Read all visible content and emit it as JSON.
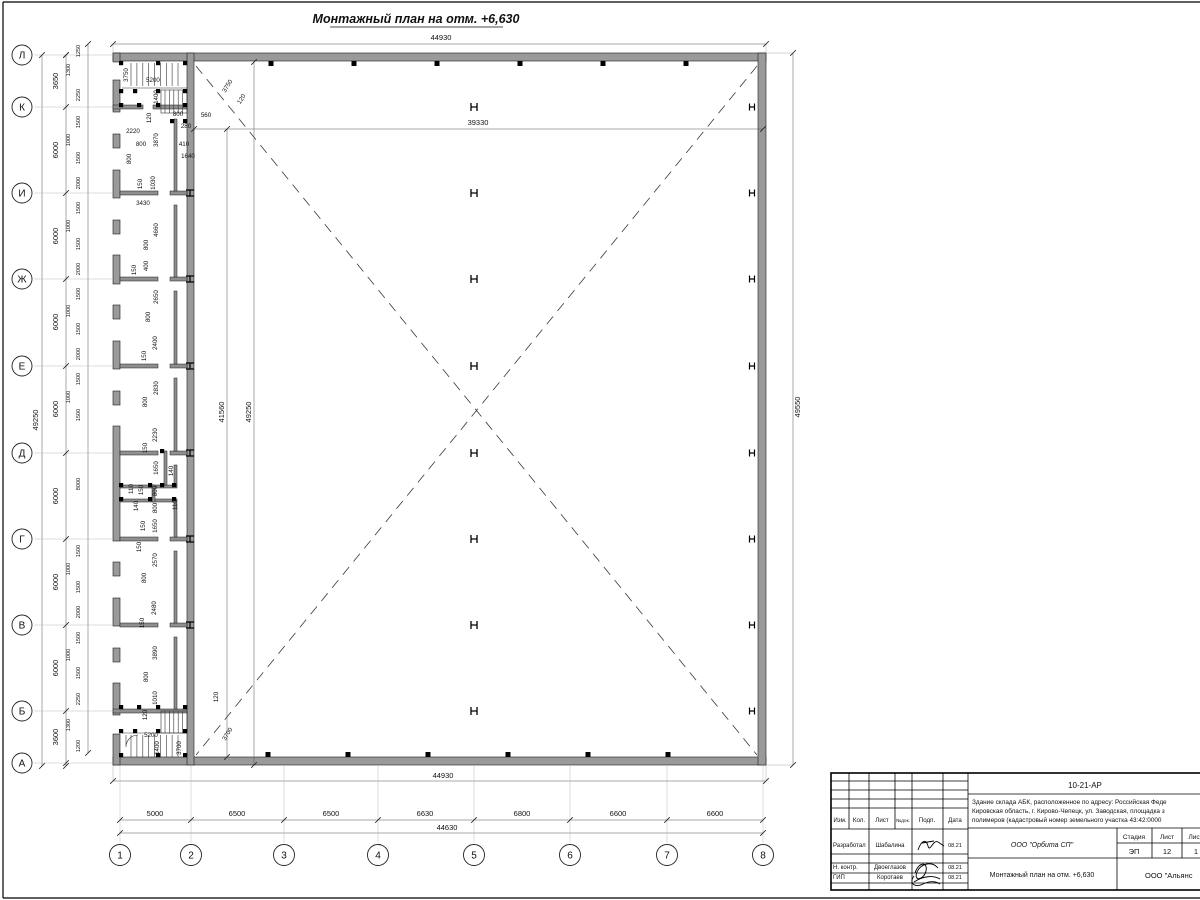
{
  "title": {
    "text": "Монтажный план на отм. +6,630"
  },
  "axes": {
    "left": [
      {
        "l": "Л",
        "y": 55
      },
      {
        "l": "К",
        "y": 107
      },
      {
        "l": "И",
        "y": 193
      },
      {
        "l": "Ж",
        "y": 279
      },
      {
        "l": "Е",
        "y": 366
      },
      {
        "l": "Д",
        "y": 453
      },
      {
        "l": "Г",
        "y": 539
      },
      {
        "l": "В",
        "y": 625
      },
      {
        "l": "Б",
        "y": 711
      },
      {
        "l": "А",
        "y": 763
      }
    ],
    "bottom": [
      {
        "l": "1",
        "x": 120
      },
      {
        "l": "2",
        "x": 191
      },
      {
        "l": "3",
        "x": 284
      },
      {
        "l": "4",
        "x": 378
      },
      {
        "l": "5",
        "x": 474
      },
      {
        "l": "6",
        "x": 570
      },
      {
        "l": "7",
        "x": 667
      },
      {
        "l": "8",
        "x": 763
      }
    ]
  },
  "dims": {
    "top_overall": {
      "t": "44930"
    },
    "bottom_inner": {
      "t": "44930"
    },
    "bottom_overall": {
      "t": "44630"
    },
    "left_overall": {
      "t": "49250"
    },
    "right_overall": {
      "t": "49550"
    },
    "hall_width": {
      "t": "39330"
    },
    "hall_h1": {
      "t": "41560"
    },
    "hall_h2": {
      "t": "49250"
    },
    "bottom_segments": [
      {
        "t": "5000",
        "x": 155
      },
      {
        "t": "6500",
        "x": 237
      },
      {
        "t": "6500",
        "x": 331
      },
      {
        "t": "6630",
        "x": 425
      },
      {
        "t": "6800",
        "x": 522
      },
      {
        "t": "6600",
        "x": 618
      },
      {
        "t": "6600",
        "x": 715
      }
    ],
    "left_axis_segments": [
      {
        "t": "3650",
        "y": 81
      },
      {
        "t": "6000",
        "y": 150
      },
      {
        "t": "6000",
        "y": 236
      },
      {
        "t": "6000",
        "y": 322
      },
      {
        "t": "6000",
        "y": 409
      },
      {
        "t": "6000",
        "y": 496
      },
      {
        "t": "6000",
        "y": 582
      },
      {
        "t": "6000",
        "y": 668
      },
      {
        "t": "3600",
        "y": 737
      }
    ],
    "left_chain": [
      {
        "t": "1250",
        "y": 51
      },
      {
        "t": "1300",
        "y": 70,
        "x": 70
      },
      {
        "t": "2250",
        "y": 95
      },
      {
        "t": "1500",
        "y": 122
      },
      {
        "t": "1000",
        "y": 140,
        "x": 70
      },
      {
        "t": "1500",
        "y": 158
      },
      {
        "t": "2000",
        "y": 183
      },
      {
        "t": "1500",
        "y": 208
      },
      {
        "t": "1000",
        "y": 226,
        "x": 70
      },
      {
        "t": "1500",
        "y": 244
      },
      {
        "t": "2000",
        "y": 269
      },
      {
        "t": "1500",
        "y": 294
      },
      {
        "t": "1000",
        "y": 311,
        "x": 70
      },
      {
        "t": "1500",
        "y": 329
      },
      {
        "t": "2000",
        "y": 354
      },
      {
        "t": "1500",
        "y": 379
      },
      {
        "t": "1000",
        "y": 397,
        "x": 70
      },
      {
        "t": "1500",
        "y": 415
      },
      {
        "t": "8000",
        "y": 484
      },
      {
        "t": "1500",
        "y": 551
      },
      {
        "t": "1000",
        "y": 569,
        "x": 70
      },
      {
        "t": "1500",
        "y": 587
      },
      {
        "t": "2000",
        "y": 612
      },
      {
        "t": "1500",
        "y": 638
      },
      {
        "t": "1000",
        "y": 655,
        "x": 70
      },
      {
        "t": "1500",
        "y": 673
      },
      {
        "t": "2250",
        "y": 699
      },
      {
        "t": "1300",
        "y": 725,
        "x": 70
      },
      {
        "t": "1200",
        "y": 746
      }
    ]
  },
  "annotations": [
    {
      "t": "3750",
      "x": 128,
      "y": 75,
      "r": -90
    },
    {
      "t": "5200",
      "x": 153,
      "y": 82
    },
    {
      "t": "1400",
      "x": 158,
      "y": 97,
      "r": -90
    },
    {
      "t": "120",
      "x": 151,
      "y": 118,
      "r": -90
    },
    {
      "t": "2220",
      "x": 133,
      "y": 133
    },
    {
      "t": "800",
      "x": 141,
      "y": 146
    },
    {
      "t": "3870",
      "x": 158,
      "y": 140,
      "r": -90
    },
    {
      "t": "800",
      "x": 178,
      "y": 116
    },
    {
      "t": "280",
      "x": 186,
      "y": 128
    },
    {
      "t": "410",
      "x": 184,
      "y": 146
    },
    {
      "t": "1640",
      "x": 188,
      "y": 158
    },
    {
      "t": "560",
      "x": 206,
      "y": 117
    },
    {
      "t": "3750",
      "x": 229,
      "y": 87,
      "r": -58
    },
    {
      "t": "120",
      "x": 243,
      "y": 100,
      "r": -58
    },
    {
      "t": "800",
      "x": 131,
      "y": 159,
      "r": -90
    },
    {
      "t": "150",
      "x": 142,
      "y": 184,
      "r": -90
    },
    {
      "t": "1030",
      "x": 155,
      "y": 183,
      "r": -90
    },
    {
      "t": "3430",
      "x": 143,
      "y": 205
    },
    {
      "t": "4660",
      "x": 158,
      "y": 230,
      "r": -90
    },
    {
      "t": "800",
      "x": 148,
      "y": 245,
      "r": -90
    },
    {
      "t": "400",
      "x": 148,
      "y": 266,
      "r": -90
    },
    {
      "t": "150",
      "x": 136,
      "y": 270,
      "r": -90
    },
    {
      "t": "2650",
      "x": 158,
      "y": 297,
      "r": -90
    },
    {
      "t": "800",
      "x": 150,
      "y": 317,
      "r": -90
    },
    {
      "t": "2400",
      "x": 157,
      "y": 343,
      "r": -90
    },
    {
      "t": "150",
      "x": 146,
      "y": 356,
      "r": -90
    },
    {
      "t": "2830",
      "x": 158,
      "y": 388,
      "r": -90
    },
    {
      "t": "800",
      "x": 147,
      "y": 402,
      "r": -90
    },
    {
      "t": "2230",
      "x": 157,
      "y": 435,
      "r": -90
    },
    {
      "t": "150",
      "x": 147,
      "y": 448,
      "r": -90
    },
    {
      "t": "1650",
      "x": 158,
      "y": 468,
      "r": -90
    },
    {
      "t": "140",
      "x": 173,
      "y": 471,
      "r": -90
    },
    {
      "t": "110",
      "x": 133,
      "y": 489,
      "r": -90
    },
    {
      "t": "150",
      "x": 143,
      "y": 490,
      "r": -90
    },
    {
      "t": "800",
      "x": 157,
      "y": 491,
      "r": -90
    },
    {
      "t": "140",
      "x": 138,
      "y": 506,
      "r": -90
    },
    {
      "t": "800",
      "x": 157,
      "y": 508,
      "r": -90
    },
    {
      "t": "110",
      "x": 177,
      "y": 505,
      "r": -90
    },
    {
      "t": "150",
      "x": 145,
      "y": 526,
      "r": -90
    },
    {
      "t": "1650",
      "x": 157,
      "y": 526,
      "r": -90
    },
    {
      "t": "150",
      "x": 141,
      "y": 547,
      "r": -90
    },
    {
      "t": "2570",
      "x": 157,
      "y": 560,
      "r": -90
    },
    {
      "t": "800",
      "x": 146,
      "y": 578,
      "r": -90
    },
    {
      "t": "2480",
      "x": 156,
      "y": 608,
      "r": -90
    },
    {
      "t": "150",
      "x": 144,
      "y": 623,
      "r": -90
    },
    {
      "t": "3890",
      "x": 157,
      "y": 653,
      "r": -90
    },
    {
      "t": "800",
      "x": 148,
      "y": 677,
      "r": -90
    },
    {
      "t": "1010",
      "x": 157,
      "y": 698,
      "r": -90
    },
    {
      "t": "120",
      "x": 147,
      "y": 715,
      "r": -90
    },
    {
      "t": "120",
      "x": 218,
      "y": 697,
      "r": -90
    },
    {
      "t": "5200",
      "x": 151,
      "y": 737
    },
    {
      "t": "1400",
      "x": 159,
      "y": 748,
      "r": -90
    },
    {
      "t": "3700",
      "x": 181,
      "y": 748,
      "r": -90
    },
    {
      "t": "3700",
      "x": 229,
      "y": 735,
      "r": -58
    }
  ],
  "columns": {
    "mid_x": 474,
    "right_x": 752,
    "wall_x": 190,
    "rows": [
      107,
      193,
      279,
      366,
      453,
      539,
      625,
      711
    ]
  },
  "wall_posts": {
    "top": {
      "y": 61,
      "xs": [
        271,
        354,
        437,
        520,
        603,
        686
      ]
    },
    "bottom": {
      "y": 752,
      "xs": [
        268,
        348,
        428,
        508,
        588,
        668
      ]
    }
  },
  "titleblock": {
    "doc_number": "10-21-АР",
    "address_lines": [
      "Здание склада АБК, расположенное по адресу: Российская Феде",
      "Кировская область, г. Кирово-Чепецк, ул. Заводская, площадка з",
      "полимеров (кадастровый номер земельного участка 43:42:0000"
    ],
    "header_cols": [
      {
        "t": "Изм.",
        "x": 840
      },
      {
        "t": "Кол.",
        "x": 859
      },
      {
        "t": "Лист",
        "x": 882
      },
      {
        "t": "№док.",
        "x": 903
      },
      {
        "t": "Подп.",
        "x": 927
      },
      {
        "t": "Дата",
        "x": 955
      }
    ],
    "rows": [
      {
        "role": "Разработал",
        "name": "Шабалина",
        "date": "08.21",
        "y": 847
      },
      {
        "role": "Н. контр.",
        "name": "Двоеглазов",
        "date": "08.21",
        "y": 869
      },
      {
        "role": "ГИП",
        "name": "Коротаев",
        "date": "08.21",
        "y": 879
      }
    ],
    "org": "ООО \"Орбита СП\"",
    "stage_label": "Стадия",
    "sheet_label": "Лист",
    "sheets_label": "Листов",
    "stage": "ЭП",
    "sheet": "12",
    "sheets": "1",
    "drawing_title": "Монтажный план на отм. +6,630",
    "company": "ООО \"Альянс"
  }
}
